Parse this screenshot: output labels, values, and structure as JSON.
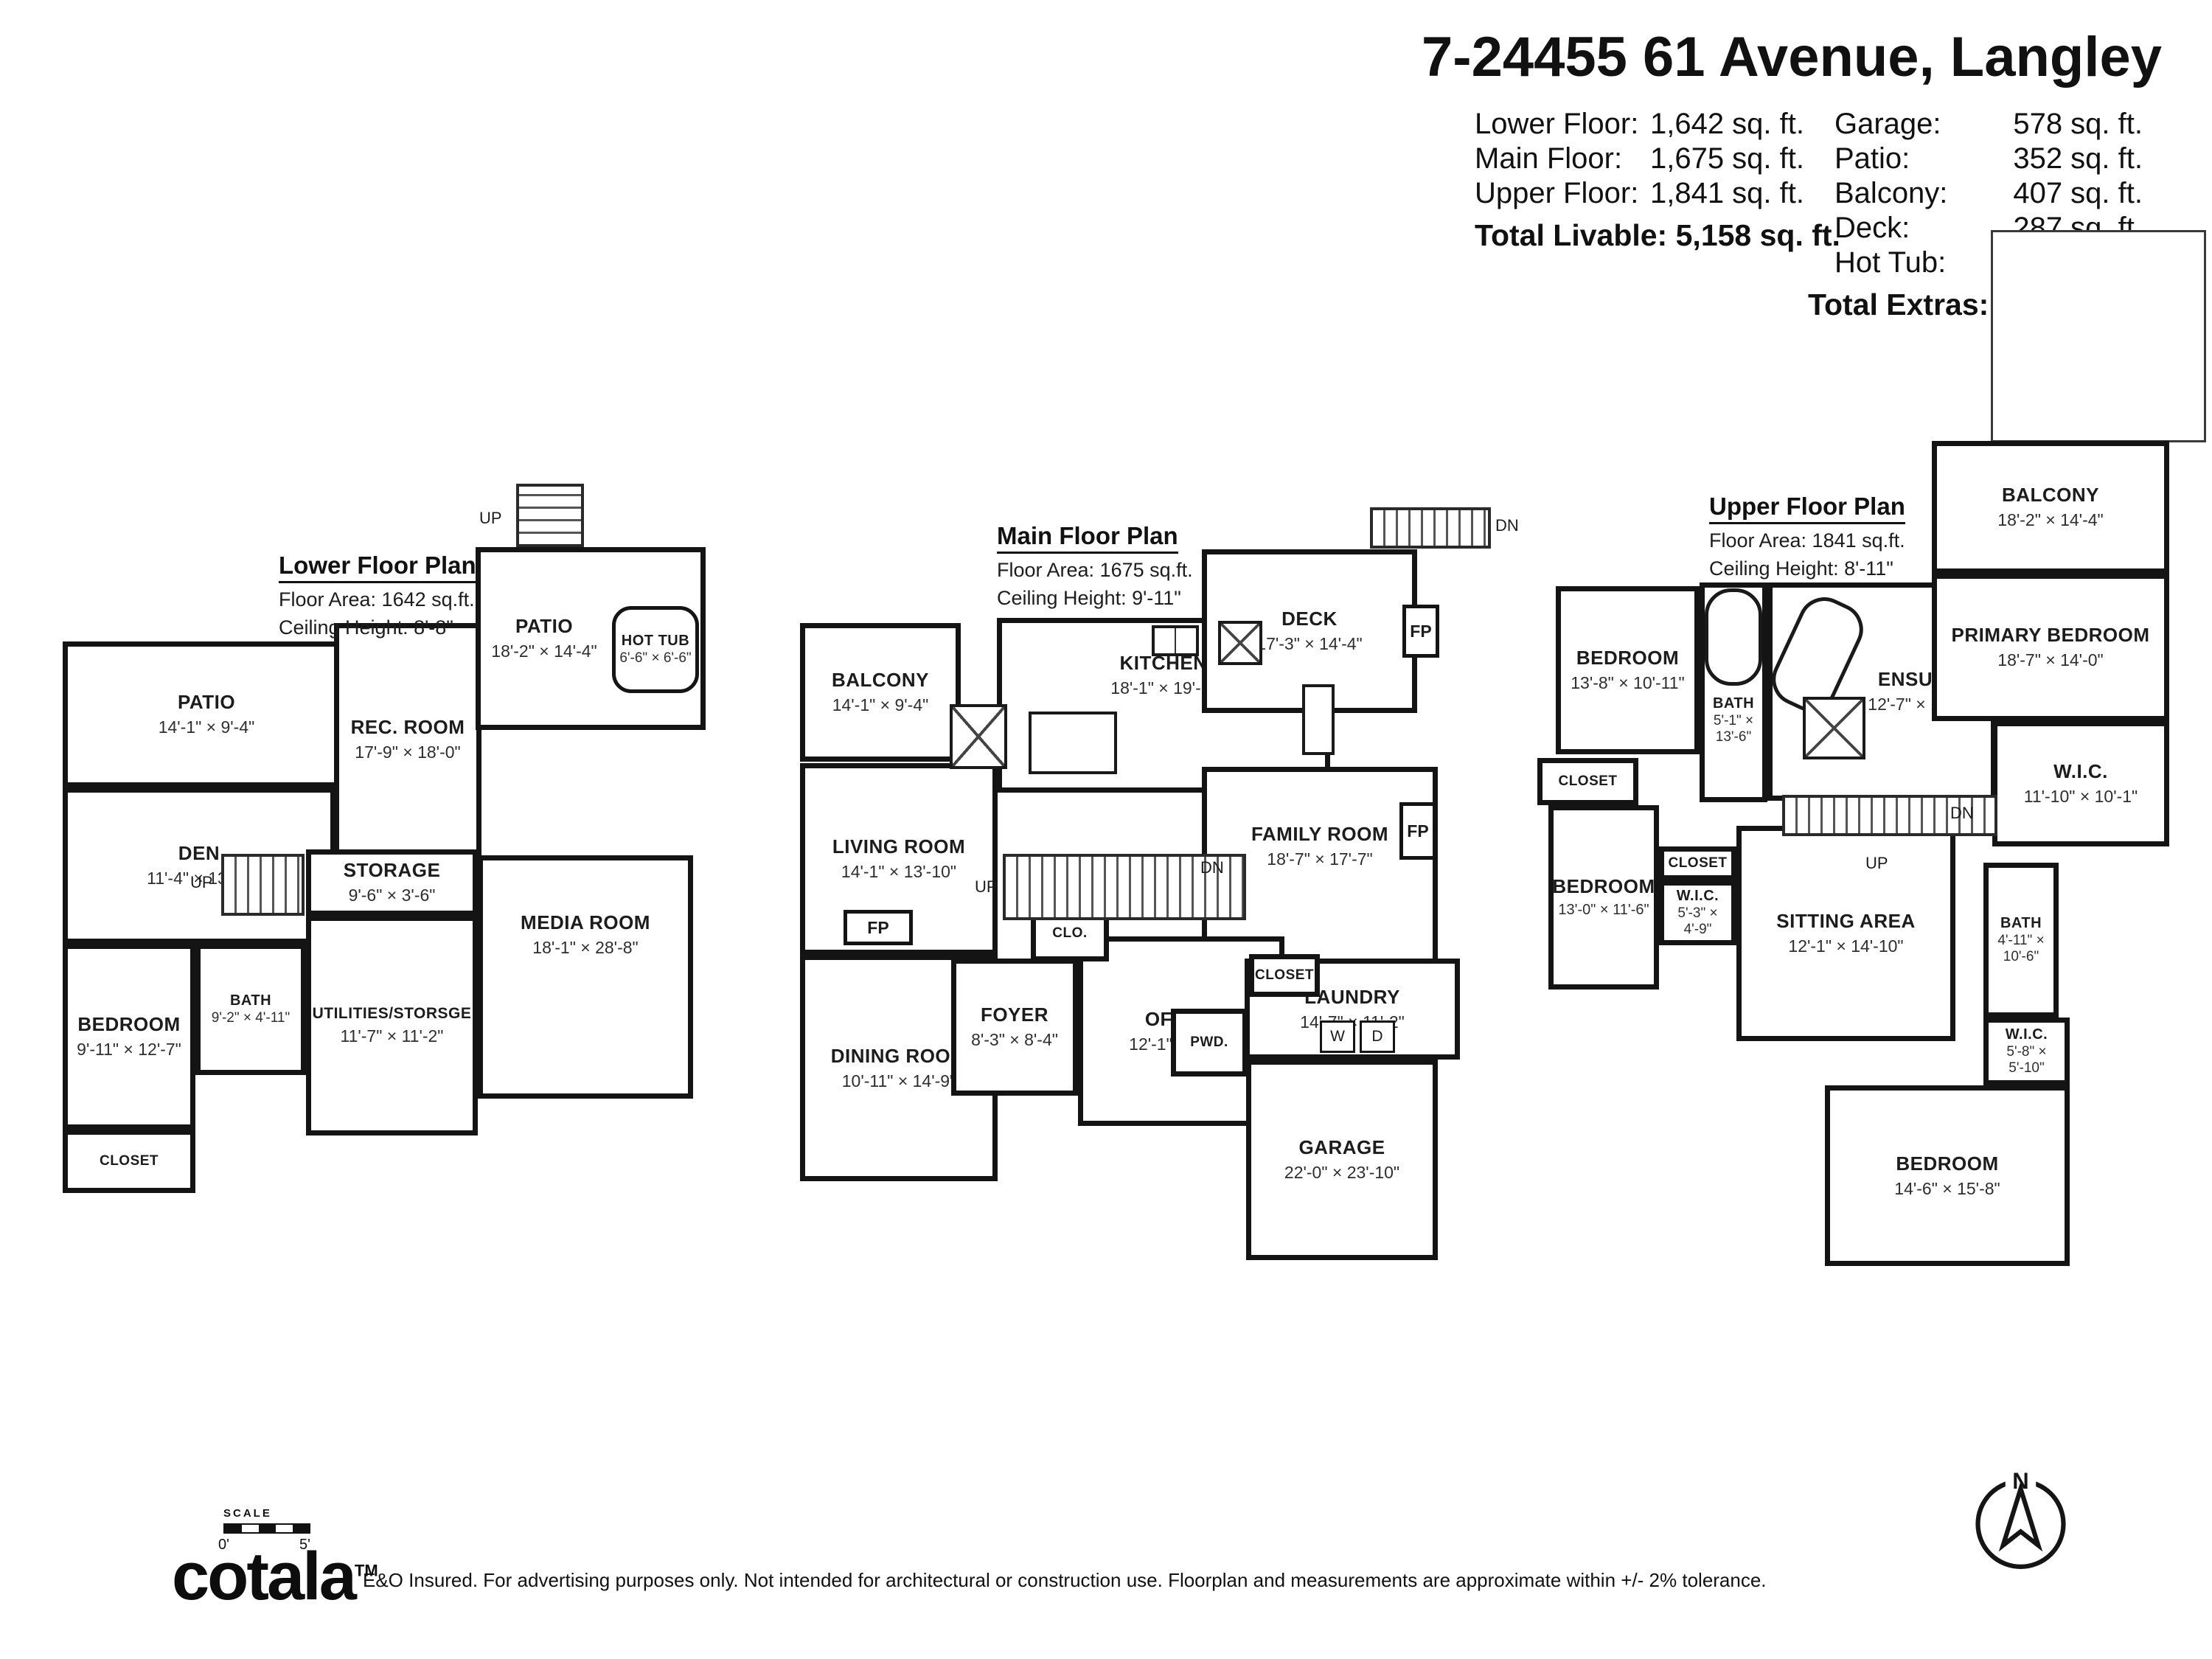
{
  "header": {
    "title": "7-24455 61 Avenue, Langley",
    "left_stats": [
      {
        "label": "Lower Floor:",
        "value": "1,642 sq. ft."
      },
      {
        "label": "Main Floor:",
        "value": "1,675 sq. ft."
      },
      {
        "label": "Upper Floor:",
        "value": "1,841 sq. ft."
      }
    ],
    "left_total": {
      "label": "Total Livable:",
      "value": "5,158 sq. ft."
    },
    "right_stats": [
      {
        "label": "Garage:",
        "value": "578 sq. ft."
      },
      {
        "label": "Patio:",
        "value": "352 sq. ft."
      },
      {
        "label": "Balcony:",
        "value": "407 sq. ft."
      },
      {
        "label": "Deck:",
        "value": "287 sq. ft."
      },
      {
        "label": "Hot Tub:",
        "value": "42 sq. ft."
      }
    ],
    "right_total": {
      "label": "Total Extras:",
      "value": "1,666 sq. ft."
    }
  },
  "floors": [
    {
      "title": "Lower Floor Plan",
      "area": "Floor Area: 1642 sq.ft.",
      "ceiling": "Ceiling Height: 8'-8\"",
      "rooms": [
        {
          "name": "PATIO",
          "dims": "14'-1\" × 9'-4\""
        },
        {
          "name": "DEN",
          "dims": "11'-4\" × 13'-2\""
        },
        {
          "name": "REC. ROOM",
          "dims": "17'-9\" × 18'-0\""
        },
        {
          "name": "PATIO",
          "dims": "18'-2\" × 14'-4\""
        },
        {
          "name": "HOT TUB",
          "dims": "6'-6\" × 6'-6\""
        },
        {
          "name": "STORAGE",
          "dims": "9'-6\" × 3'-6\""
        },
        {
          "name": "UTILITIES/STORSGE",
          "dims": "11'-7\" × 11'-2\""
        },
        {
          "name": "MEDIA ROOM",
          "dims": "18'-1\" × 28'-8\""
        },
        {
          "name": "BEDROOM",
          "dims": "9'-11\" × 12'-7\""
        },
        {
          "name": "BATH",
          "dims": "9'-2\" × 4'-11\""
        },
        {
          "name": "CLOSET"
        }
      ]
    },
    {
      "title": "Main Floor Plan",
      "area": "Floor Area: 1675 sq.ft.",
      "ceiling": "Ceiling Height: 9'-11\"",
      "rooms": [
        {
          "name": "BALCONY",
          "dims": "14'-1\" × 9'-4\""
        },
        {
          "name": "KITCHEN",
          "dims": "18'-1\" × 19'-1\""
        },
        {
          "name": "DECK",
          "dims": "17'-3\" × 14'-4\""
        },
        {
          "name": "LIVING ROOM",
          "dims": "14'-1\" × 13'-10\""
        },
        {
          "name": "FAMILY ROOM",
          "dims": "18'-7\" × 17'-7\""
        },
        {
          "name": "DINING ROOM",
          "dims": "10'-11\" × 14'-9\""
        },
        {
          "name": "FOYER",
          "dims": "8'-3\" × 8'-4\""
        },
        {
          "name": "CLO."
        },
        {
          "name": "OFFICE",
          "dims": "12'-1\" × 11'-8\""
        },
        {
          "name": "LAUNDRY",
          "dims": "14'-7\" × 11'-2\""
        },
        {
          "name": "PWD."
        },
        {
          "name": "CLOSET"
        },
        {
          "name": "GARAGE",
          "dims": "22'-0\" × 23'-10\""
        }
      ]
    },
    {
      "title": "Upper Floor Plan",
      "area": "Floor Area: 1841 sq.ft.",
      "ceiling": "Ceiling Height: 8'-11\"",
      "rooms": [
        {
          "name": "BEDROOM",
          "dims": "13'-8\" × 10'-11\""
        },
        {
          "name": "BATH",
          "dims": "5'-1\" × 13'-6\""
        },
        {
          "name": "ENSUITE",
          "dims": "12'-7\" × 14'-1\""
        },
        {
          "name": "BALCONY",
          "dims": "18'-2\" × 14'-4\""
        },
        {
          "name": "PRIMARY BEDROOM",
          "dims": "18'-7\" × 14'-0\""
        },
        {
          "name": "W.I.C.",
          "dims": "11'-10\" × 10'-1\""
        },
        {
          "name": "CLOSET"
        },
        {
          "name": "BEDROOM",
          "dims": "13'-0\" × 11'-6\""
        },
        {
          "name": "CLOSET"
        },
        {
          "name": "W.I.C.",
          "dims": "5'-3\" × 4'-9\""
        },
        {
          "name": "SITTING AREA",
          "dims": "12'-1\" × 14'-10\""
        },
        {
          "name": "BATH",
          "dims": "4'-11\" × 10'-6\""
        },
        {
          "name": "W.I.C.",
          "dims": "5'-8\" × 5'-10\""
        },
        {
          "name": "BEDROOM",
          "dims": "14'-6\" × 15'-8\""
        }
      ]
    }
  ],
  "labels": {
    "up": "UP",
    "dn": "DN",
    "fp": "FP",
    "washer": "W",
    "dryer": "D"
  },
  "compass": {
    "north": "N"
  },
  "footer": {
    "scale_label": "SCALE",
    "scale_start": "0'",
    "scale_end": "5'",
    "brand": "cotala",
    "trademark": "TM",
    "disclaimer": "E&O Insured. For advertising purposes only. Not intended for architectural or construction use. Floorplan and measurements are approximate within +/- 2% tolerance."
  }
}
